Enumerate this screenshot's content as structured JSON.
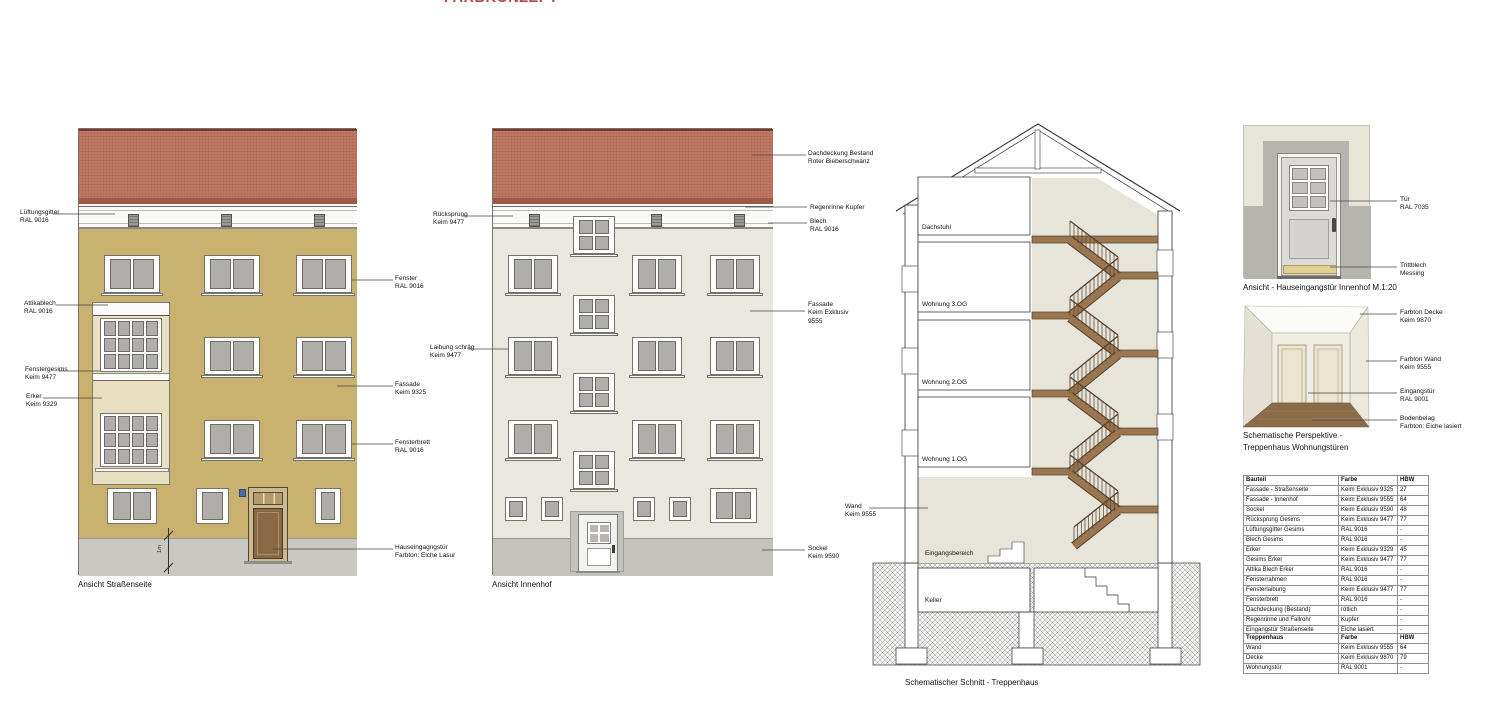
{
  "masthead": {
    "clipped_title": "FARBKONZEPT"
  },
  "colors": {
    "facade_street": "#C9B170",
    "facade_courtyard": "#E9E7E0",
    "roof_tile": "#BD7963",
    "sockel": "#C6C4BF",
    "erker": "#E9E0C1",
    "door_wood": "#8A6A45",
    "stair_wood": "#9A7750",
    "door_ral7035": "#DCDBD7",
    "brass": "#E0D094",
    "accent_red": "#B4453C"
  },
  "street_elevation": {
    "caption": "Ansicht Straßenseite",
    "scale_marker": "1m",
    "labels": {
      "lueftungsgitter": "Lüftungsgitter\nRAL 9016",
      "attikablech": "Attikablech\nRAL 9016",
      "fenstergesims": "Fenstergesims\nKeim 9477",
      "erker": "Erker\nKeim 9329",
      "fenster": "Fenster\nRAL 9016",
      "fassade": "Fassade\nKeim 9325",
      "fensterbrett": "Fensterbrett\nRAL 9016",
      "hauseingangstuer": "Hauseingagngstür\nFarbton: Eiche Lasur"
    }
  },
  "courtyard_elevation": {
    "caption": "Ansicht Innenhof",
    "labels": {
      "ruecksprung": "Rücksprung\nKeim 9477",
      "laibung": "Laibung schräg\nKeim 9477",
      "dachdeckung": "Dachdeckung Bestand\nRoter Bieberschwanz",
      "regenrinne": "Regenrinne Kupfer",
      "blech": "Blech\nRAL 9016",
      "fassade": "Fassade\nKeim Exklusiv\n9555",
      "sockel": "Sockel\nKeim 9590"
    }
  },
  "section": {
    "caption": "Schematischer Schnitt - Treppenhaus",
    "labels": {
      "wand": "Wand\nKeim 9555"
    },
    "rooms": {
      "dachstuhl": "Dachstuhl",
      "og3": "Wohnung 3.OG",
      "og2": "Wohnung 2.OG",
      "og1": "Wohnung 1.OG",
      "eingang": "Eingangsbereich",
      "keller": "Keller"
    }
  },
  "door_detail": {
    "caption": "Ansicht - Hauseingangstür Innenhof M.1:20",
    "labels": {
      "tuer": "Tür\nRAL 7035",
      "trittblech": "Trittblech\nMessing"
    }
  },
  "perspective": {
    "caption": "Schematische Perspektive -\nTreppenhaus Wohnungstüren",
    "labels": {
      "decke": "Farbton Decke\nKeim 9870",
      "wand": "Farbton Wand\nKeim 9555",
      "eingangstuer": "Eingangstür\nRAL 9001",
      "boden": "Bodenbelag\nFarbton: Eiche lasiert"
    }
  },
  "tables": {
    "bauteil": {
      "headers": [
        "Bauteil",
        "Farbe",
        "HBW"
      ],
      "rows": [
        [
          "Fassade - Straßenseite",
          "Keim Exklusiv 9325",
          "27"
        ],
        [
          "Fassade - Innenhof",
          "Keim Exklusiv 9555",
          "64"
        ],
        [
          "Sockel",
          "Keim Exklusiv 9590",
          "48"
        ],
        [
          "Rücksprung Gesims",
          "Keim Exklusiv 9477",
          "77"
        ],
        [
          "Lüftungsgitter Gesims",
          "RAL 9016",
          "-"
        ],
        [
          "Blech Gesims",
          "RAL 9016",
          "-"
        ],
        [
          "Erker",
          "Keim Exklusiv 9329",
          "45"
        ],
        [
          "Gesims Erker",
          "Keim Exklusiv 9477",
          "77"
        ],
        [
          "Attika Blech Erker",
          "RAL 9016",
          "-"
        ],
        [
          "Fensterrahmen",
          "RAL 9016",
          "-"
        ],
        [
          "Fensterlaibung",
          "Keim Exklusiv 9477",
          "77"
        ],
        [
          "Fensterbrett",
          "RAL 9016",
          "-"
        ],
        [
          "Dachdeckung (Bestand)",
          "rötlich",
          "-"
        ],
        [
          "Regenrinne und Fallrohr",
          "Kupfer",
          "-"
        ],
        [
          "Eingangstür Straßenseite",
          "Eiche lasiert",
          "-"
        ],
        [
          "Eingangstür Innenhof - Türblatt",
          "RAL 7035",
          "-"
        ],
        [
          "Eingangstür Innenhof - Trittblech",
          "Messing",
          "-"
        ]
      ]
    },
    "treppenhaus": {
      "headers": [
        "Treppenhaus",
        "Farbe",
        "HBW"
      ],
      "rows": [
        [
          "Wand",
          "Keim Exklusiv 9555",
          "64"
        ],
        [
          "Decke",
          "Keim Exklusiv 9870",
          "79"
        ],
        [
          "Wohnungstür",
          "RAL 9001",
          "-"
        ]
      ]
    }
  }
}
